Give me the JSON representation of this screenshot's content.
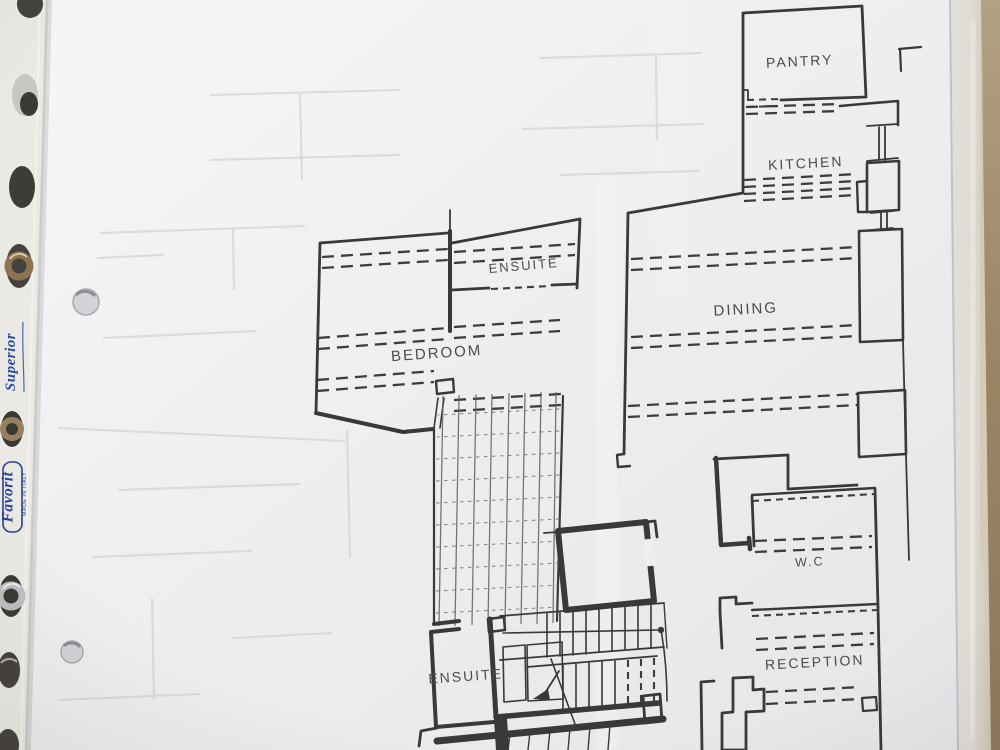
{
  "rooms": [
    {
      "id": "pantry",
      "label": "PANTRY"
    },
    {
      "id": "kitchen",
      "label": "KITCHEN"
    },
    {
      "id": "dining",
      "label": "DINING"
    },
    {
      "id": "ensuite-upper",
      "label": "ENSUITE"
    },
    {
      "id": "bedroom",
      "label": "BEDROOM"
    },
    {
      "id": "wc",
      "label": "W.C"
    },
    {
      "id": "reception",
      "label": "RECEPTION"
    },
    {
      "id": "ensuite-lower",
      "label": "ENSUITE"
    }
  ],
  "sleeve": {
    "brand": "Favorit",
    "made_in": "MADE IN ITALY",
    "series": "Superior"
  },
  "colors": {
    "plan_line": "#39383a",
    "paper": "#f2f1f3",
    "sleeve_brand_blue": "#2b4fa0",
    "backdrop_brown": "#9a8465",
    "sleeve_strip": "#ebe9e4"
  }
}
